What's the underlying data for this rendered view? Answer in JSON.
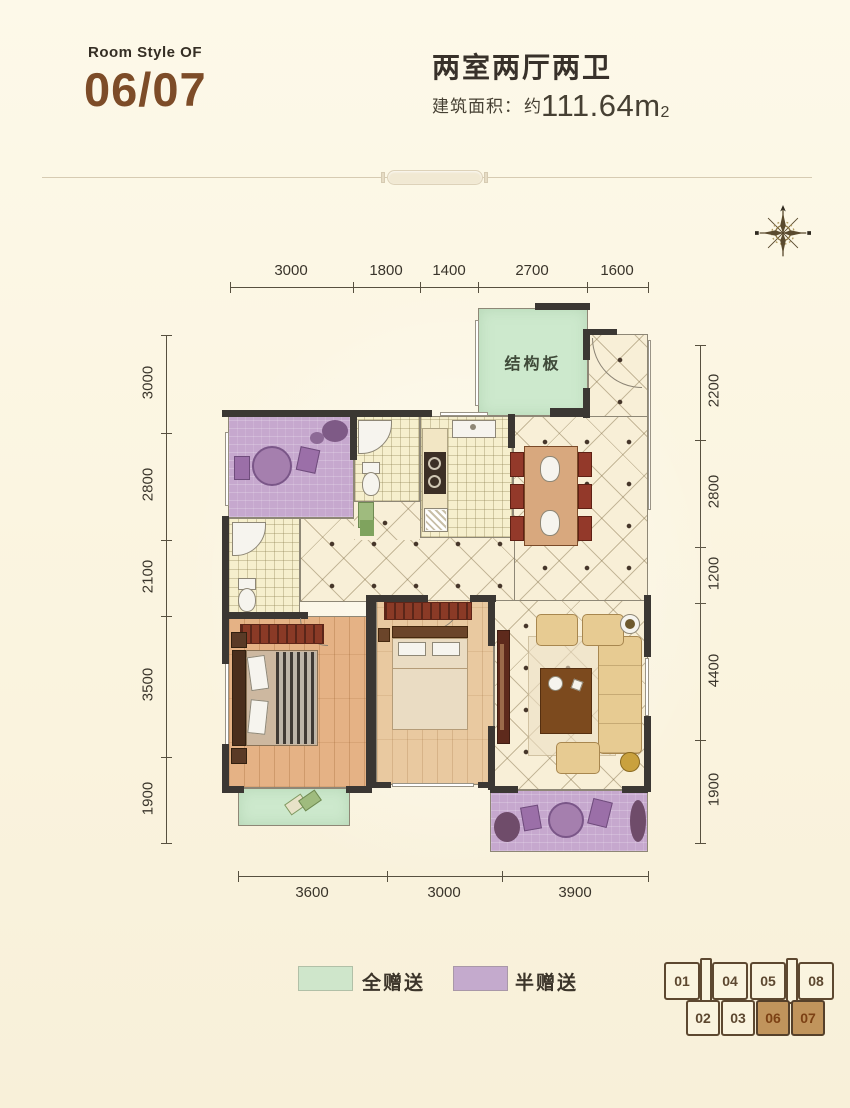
{
  "header": {
    "room_style_label": "Room Style OF",
    "room_numbers": "06/07",
    "layout_title": "两室两厅两卫",
    "area_label": "建筑面积：",
    "area_approx": "约",
    "area_value": "111.64m",
    "area_exponent": "2"
  },
  "icons": {
    "compass": "compass-rose-icon"
  },
  "plan": {
    "slab_label": "结构板",
    "dimensions": {
      "top": [
        "3000",
        "1800",
        "1400",
        "2700",
        "1600"
      ],
      "bottom": [
        "3600",
        "3000",
        "3900"
      ],
      "left": [
        "3000",
        "2800",
        "2100",
        "3500",
        "1900"
      ],
      "right": [
        "2200",
        "2800",
        "1200",
        "4400",
        "1900"
      ]
    }
  },
  "legend": {
    "items": [
      {
        "label": "全赠送",
        "color": "#cfe6cb"
      },
      {
        "label": "半赠送",
        "color": "#c4aacd"
      }
    ]
  },
  "key_plan": {
    "units": [
      {
        "label": "01",
        "highlighted": false
      },
      {
        "label": "04",
        "highlighted": false
      },
      {
        "label": "05",
        "highlighted": false
      },
      {
        "label": "08",
        "highlighted": false
      },
      {
        "label": "02",
        "highlighted": false
      },
      {
        "label": "03",
        "highlighted": false
      },
      {
        "label": "06",
        "highlighted": true
      },
      {
        "label": "07",
        "highlighted": true
      }
    ]
  },
  "colors": {
    "accent_brown": "#7d4c28",
    "full_gift_green": "#cfe6cb",
    "half_gift_purple": "#c4aacd",
    "highlight_tan": "#c0945c",
    "wall_dark": "#3b3733",
    "background_cream": "#fbf5e2"
  }
}
